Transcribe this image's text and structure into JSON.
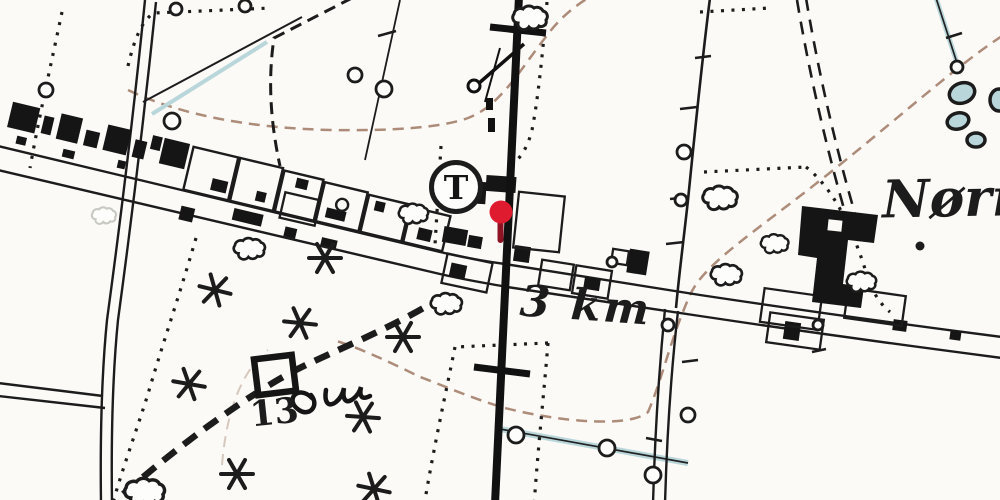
{
  "map": {
    "type": "historical-topographic-map",
    "labels": {
      "place_name": "Nørre",
      "distance_marker": "3 km",
      "parcel_number": "13",
      "telephone_station": "T"
    },
    "marker": {
      "icon": "location-pin",
      "head_color": "#df1b2f",
      "stem_color": "#8e1424"
    },
    "colors": {
      "paper": "#fbfaf7",
      "ink": "#1c1c1c",
      "water": "#b9d6da",
      "contour": "#a5806c",
      "faint": "#c9c9c3"
    },
    "symbols": {
      "telephone": "telephone-station-circle",
      "railway": "railway-line",
      "meadow": "meadow-star",
      "trees": "bush-cloud",
      "track": "dashed-cart-track"
    }
  }
}
